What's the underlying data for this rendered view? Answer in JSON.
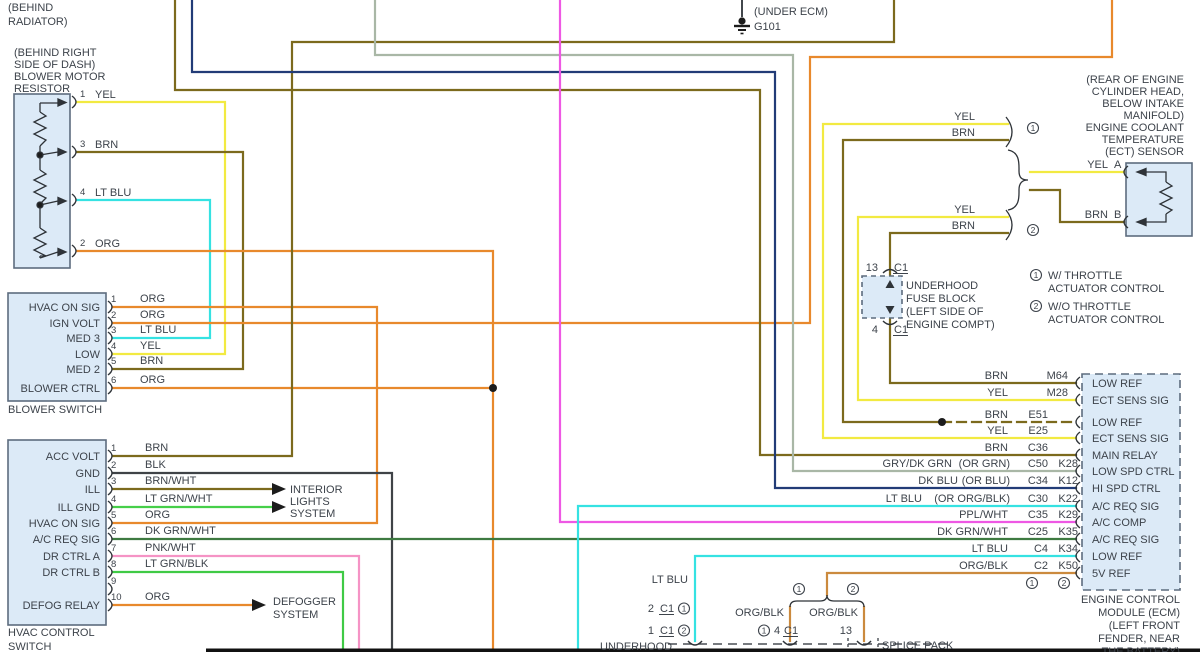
{
  "colors": {
    "yel": "#f2ea41",
    "brn": "#7c6a1d",
    "lt_blu": "#35e2e2",
    "org": "#e8892c",
    "blk": "#3f4347",
    "brn_wht": "#7c6a1d",
    "lt_grn_wht": "#46cf49",
    "dk_grn_wht": "#3e7a41",
    "pnk_wht": "#f593c5",
    "lt_grn_blk": "#3fca45",
    "gry_dk_grn": "#a9b7a6",
    "dk_blu": "#223c77",
    "ppl_wht": "#ee58e4",
    "org_blk": "#cb8a3e",
    "box_fill": "#dceaf7",
    "box_stroke": "#5d6c7e",
    "text": "#3d434b",
    "bar": "#111111"
  },
  "top": {
    "behind_radiator_1": "(BEHIND",
    "behind_radiator_2": "RADIATOR)",
    "ground_note": "(UNDER ECM)",
    "ground_label": "G101"
  },
  "blower_resistor": {
    "loc1": "(BEHIND RIGHT",
    "loc2": "SIDE OF DASH)",
    "loc3": "BLOWER MOTOR",
    "loc4": "RESISTOR",
    "pins": [
      {
        "num": "1",
        "wire": "YEL"
      },
      {
        "num": "3",
        "wire": "BRN"
      },
      {
        "num": "4",
        "wire": "LT BLU"
      },
      {
        "num": "2",
        "wire": "ORG"
      }
    ]
  },
  "blower_switch": {
    "name": "BLOWER SWITCH",
    "pins": [
      {
        "num": "1",
        "label": "HVAC ON SIG",
        "wire": "ORG"
      },
      {
        "num": "2",
        "label": "IGN VOLT",
        "wire": "ORG"
      },
      {
        "num": "3",
        "label": "MED 3",
        "wire": "LT BLU"
      },
      {
        "num": "4",
        "label": "LOW",
        "wire": "YEL"
      },
      {
        "num": "5",
        "label": "MED 2",
        "wire": "BRN"
      },
      {
        "num": "6",
        "label": "BLOWER CTRL",
        "wire": "ORG"
      }
    ]
  },
  "hvac_switch": {
    "name1": "HVAC CONTROL",
    "name2": "SWITCH",
    "pins": [
      {
        "num": "1",
        "label": "ACC VOLT",
        "wire": "BRN"
      },
      {
        "num": "2",
        "label": "GND",
        "wire": "BLK"
      },
      {
        "num": "3",
        "label": "ILL",
        "wire": "BRN/WHT"
      },
      {
        "num": "4",
        "label": "ILL GND",
        "wire": "LT GRN/WHT"
      },
      {
        "num": "5",
        "label": "HVAC ON SIG",
        "wire": "ORG"
      },
      {
        "num": "6",
        "label": "A/C REQ SIG",
        "wire": "DK GRN/WHT"
      },
      {
        "num": "7",
        "label": "DR CTRL A",
        "wire": "PNK/WHT"
      },
      {
        "num": "8",
        "label": "DR CTRL B",
        "wire": "LT GRN/BLK"
      },
      {
        "num": "9",
        "label": "",
        "wire": ""
      },
      {
        "num": "10",
        "label": "DEFOG RELAY",
        "wire": "ORG"
      }
    ]
  },
  "systems": {
    "interior1": "INTERIOR",
    "interior2": "LIGHTS",
    "interior3": "SYSTEM",
    "defog1": "DEFOGGER",
    "defog2": "SYSTEM"
  },
  "ect": {
    "loc1": "(REAR OF ENGINE",
    "loc2": "CYLINDER HEAD,",
    "loc3": "BELOW INTAKE",
    "loc4": "MANIFOLD)",
    "loc5": "ENGINE COOLANT",
    "loc6": "TEMPERATURE",
    "loc7": "(ECT) SENSOR",
    "pin_a_wire": "YEL",
    "pin_a": "A",
    "pin_b_wire": "BRN",
    "pin_b": "B",
    "pair1_yel": "YEL",
    "pair1_brn": "BRN",
    "pair1_sym": "1",
    "pair2_yel": "YEL",
    "pair2_brn": "BRN",
    "pair2_sym": "2"
  },
  "fuse_block": {
    "top_pin": "13",
    "top_conn": "C1",
    "bottom_pin": "4",
    "bottom_conn": "C1",
    "l1": "UNDERHOOD",
    "l2": "FUSE BLOCK",
    "l3": "(LEFT SIDE OF",
    "l4": "ENGINE COMPT)"
  },
  "throttle_notes": [
    {
      "sym": "1",
      "l1": "W/ THROTTLE",
      "l2": "ACTUATOR CONTROL"
    },
    {
      "sym": "2",
      "l1": "W/O THROTTLE",
      "l2": "ACTUATOR CONTROL"
    }
  ],
  "ecm": {
    "rows": [
      {
        "color": "BRN",
        "alt": "",
        "c": "",
        "k": "M64",
        "label": "LOW REF"
      },
      {
        "color": "YEL",
        "alt": "",
        "c": "",
        "k": "M28",
        "label": "ECT SENS SIG"
      },
      {
        "color": "BRN",
        "alt": "",
        "c": "E51",
        "k": "",
        "label": "LOW REF"
      },
      {
        "color": "YEL",
        "alt": "",
        "c": "E25",
        "k": "",
        "label": "ECT SENS SIG"
      },
      {
        "color": "BRN",
        "alt": "",
        "c": "C36",
        "k": "",
        "label": "MAIN RELAY"
      },
      {
        "color": "GRY/DK GRN",
        "alt": "(OR GRN)",
        "c": "C50",
        "k": "K28",
        "label": "LOW SPD CTRL"
      },
      {
        "color": "DK BLU",
        "alt": "(OR BLU)",
        "c": "C34",
        "k": "K12",
        "label": "HI SPD CTRL"
      },
      {
        "color": "LT BLU",
        "alt": "(OR ORG/BLK)",
        "c": "C30",
        "k": "K22",
        "label": "A/C REQ SIG"
      },
      {
        "color": "PPL/WHT",
        "alt": "",
        "c": "C35",
        "k": "K29",
        "label": "A/C COMP"
      },
      {
        "color": "DK GRN/WHT",
        "alt": "",
        "c": "C25",
        "k": "K35",
        "label": "A/C REQ SIG"
      },
      {
        "color": "LT BLU",
        "alt": "",
        "c": "C4",
        "k": "K34",
        "label": "LOW REF"
      },
      {
        "color": "ORG/BLK",
        "alt": "",
        "c": "C2",
        "k": "K50",
        "label": "5V REF"
      }
    ],
    "col_sym1": "1",
    "col_sym2": "2",
    "name1": "ENGINE CONTROL",
    "name2": "MODULE (ECM)",
    "name3": "(LEFT FRONT",
    "name4": "FENDER, NEAR",
    "name5": "THE BATTERY)"
  },
  "bottom": {
    "lt_blu": "LT BLU",
    "conn1_pin": "2",
    "conn1_conn": "C1",
    "conn1_sym": "1",
    "conn2_pin": "1",
    "conn2_conn": "C1",
    "conn2_sym": "2",
    "branch_sym1": "1",
    "branch_sym2": "2",
    "org_blk_1": "ORG/BLK",
    "org_blk_2": "ORG/BLK",
    "pin4_sym": "1",
    "pin4_pin": "4",
    "pin4_conn": "C1",
    "pin13": "13",
    "splice_pack": "SPLICE PACK",
    "underhood": "UNDERHOOD"
  }
}
